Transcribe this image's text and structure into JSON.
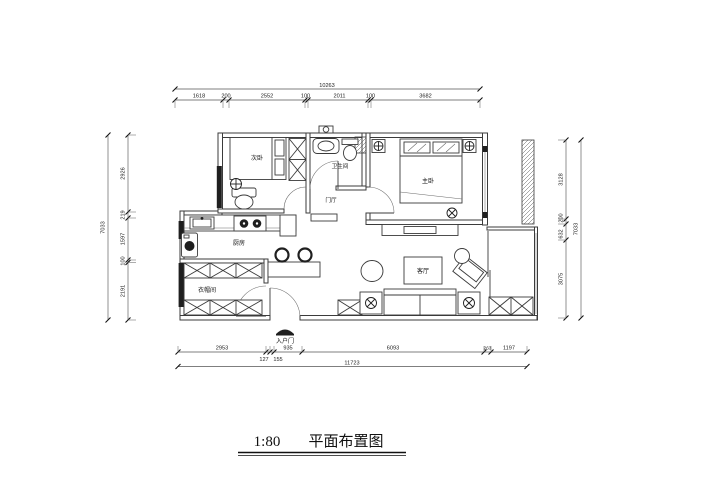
{
  "title": {
    "scale": "1:80",
    "name": "平面布置图"
  },
  "rooms": {
    "second_bedroom": "次卧",
    "bathroom": "卫生间",
    "master_bedroom": "主卧",
    "foyer": "门厅",
    "kitchen": "厨房",
    "living_room": "客厅",
    "cloakroom": "衣帽间",
    "entrance": "入户门"
  },
  "dimensions": {
    "top": {
      "total": "10263",
      "segments": [
        "1618",
        "200",
        "2552",
        "100",
        "2011",
        "100",
        "3682"
      ]
    },
    "bottom": {
      "total": "11723",
      "segments": [
        "2953",
        "127",
        "155",
        "935",
        "6093",
        "263",
        "1197"
      ]
    },
    "left": {
      "total": "7033",
      "segments": [
        "2926",
        "219",
        "1597",
        "100",
        "2191"
      ]
    },
    "right": {
      "total": "7033",
      "segments": [
        "3128",
        "200",
        "632",
        "3075"
      ]
    }
  },
  "icons": {
    "ceiling_lamp": "circle-cross lamp symbol",
    "entrance_canopy": "entry arrow canopy"
  },
  "colors": {
    "line": "#3b3b3b",
    "dark": "#1f1f1f",
    "background": "#ffffff"
  }
}
